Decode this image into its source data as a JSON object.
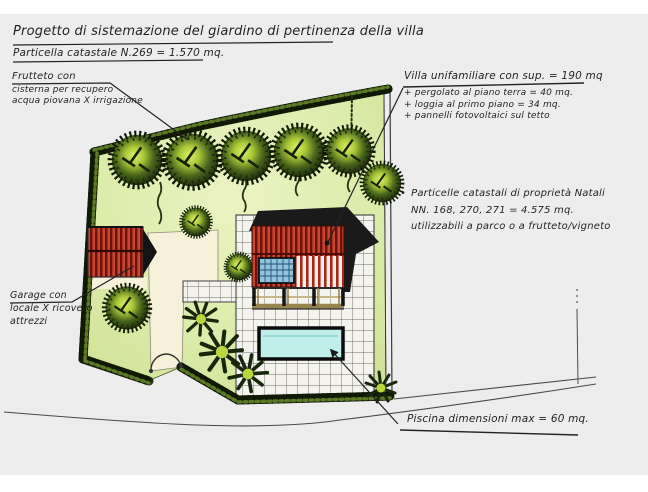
{
  "document": {
    "title": "Progetto di sistemazione del giardino di pertinenza della villa",
    "subtitle": "Particella catastale N.269 = 1.570 mq."
  },
  "annotations": {
    "frutteto": {
      "line1": "Frutteto con",
      "line2": "cisterna per recupero",
      "line3": "acqua piovana X irrigazione"
    },
    "villa": {
      "title": "Villa unifamiliare con sup. = 190 mq",
      "items": [
        "+ pergolato al piano terra = 40 mq.",
        "+ loggia al primo piano = 34 mq.",
        "+ pannelli fotovoltaici sul tetto"
      ]
    },
    "particelle": {
      "bullet": "•",
      "line1": "Particelle catastali di proprietà Natali",
      "line2": "NN. 168, 270, 271 = 4.575 mq.",
      "line3": "utilizzabili a parco o a frutteto/vigneto"
    },
    "garage": {
      "line1": "Garage con",
      "line2": "locale X ricovero",
      "line3": "attrezzi"
    },
    "piscina": {
      "label": "Piscina dimensioni max = 60 mq."
    }
  },
  "palette": {
    "scan_bg": "#ededee",
    "ink": "#262626",
    "lawn": "#dcecaa",
    "hedge_dark": "#223009",
    "foliage_light": "#cfe24a",
    "roof_red": "#a8281a",
    "roof_black": "#1a1a1a",
    "pool_water": "#bdecea",
    "panel_blue": "#8fc3de",
    "paving": "#f4f3ee",
    "driveway": "#f6f1d8"
  }
}
